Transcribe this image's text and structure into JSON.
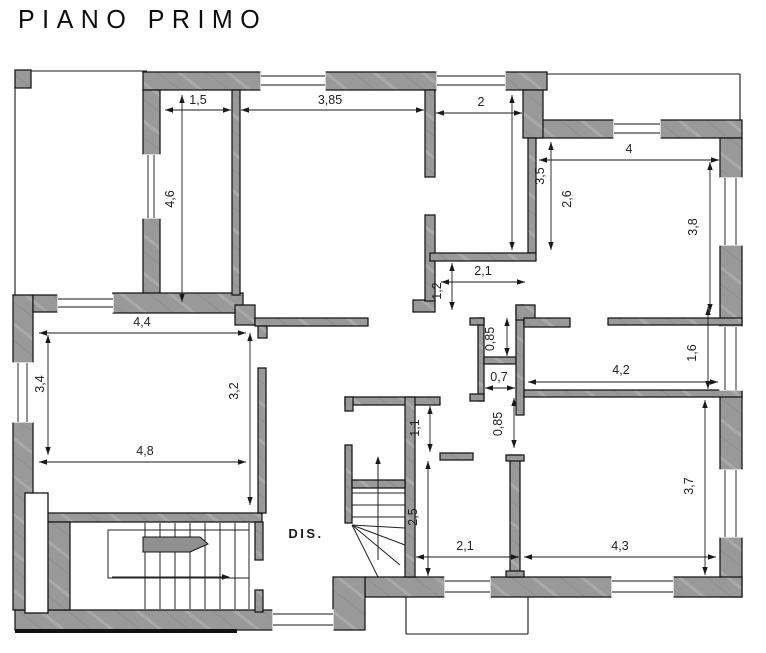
{
  "title": "PIANO PRIMO",
  "colors": {
    "wall_fill": "#999999",
    "wall_texture": "#adadad",
    "outline": "#141414",
    "dim_color": "#1a1a1a",
    "text_color": "#222222"
  },
  "room_labels": [
    {
      "t": "DIS.",
      "x": 306,
      "y": 538
    }
  ],
  "plan": {
    "walls": [
      [
        143,
        72,
        118,
        18
      ],
      [
        325,
        72,
        112,
        18
      ],
      [
        505,
        72,
        42,
        18
      ],
      [
        15,
        70,
        16,
        18
      ],
      [
        530,
        120,
        84,
        18
      ],
      [
        660,
        120,
        82,
        18
      ],
      [
        720,
        138,
        22,
        40
      ],
      [
        720,
        245,
        22,
        82
      ],
      [
        720,
        390,
        22,
        80
      ],
      [
        720,
        537,
        22,
        60
      ],
      [
        365,
        577,
        80,
        20
      ],
      [
        490,
        577,
        122,
        20
      ],
      [
        673,
        577,
        69,
        20
      ],
      [
        333,
        577,
        32,
        53
      ],
      [
        15,
        610,
        258,
        20
      ],
      [
        13,
        295,
        20,
        68
      ],
      [
        13,
        422,
        20,
        188
      ],
      [
        143,
        90,
        17,
        65
      ],
      [
        143,
        218,
        17,
        77
      ],
      [
        113,
        293,
        130,
        20
      ],
      [
        33,
        295,
        25,
        17
      ],
      [
        232,
        90,
        8,
        205
      ],
      [
        235,
        305,
        20,
        20
      ],
      [
        255,
        318,
        113,
        8
      ],
      [
        258,
        326,
        9,
        12
      ],
      [
        413,
        300,
        22,
        12
      ],
      [
        425,
        90,
        10,
        87
      ],
      [
        425,
        215,
        10,
        86
      ],
      [
        523,
        90,
        20,
        48
      ],
      [
        528,
        138,
        8,
        115
      ],
      [
        430,
        253,
        106,
        8
      ],
      [
        478,
        318,
        6,
        83
      ],
      [
        470,
        318,
        14,
        7
      ],
      [
        470,
        394,
        14,
        7
      ],
      [
        484,
        357,
        32,
        7
      ],
      [
        516,
        305,
        8,
        110
      ],
      [
        516,
        305,
        19,
        15
      ],
      [
        524,
        318,
        46,
        9
      ],
      [
        608,
        318,
        134,
        7
      ],
      [
        524,
        390,
        218,
        7
      ],
      [
        510,
        455,
        10,
        122
      ],
      [
        506,
        455,
        18,
        6
      ],
      [
        506,
        571,
        18,
        6
      ],
      [
        345,
        397,
        95,
        8
      ],
      [
        345,
        397,
        8,
        14
      ],
      [
        405,
        397,
        10,
        180
      ],
      [
        440,
        453,
        33,
        7
      ],
      [
        345,
        445,
        7,
        78
      ],
      [
        352,
        480,
        53,
        8
      ],
      [
        33,
        513,
        229,
        9
      ],
      [
        255,
        522,
        8,
        38
      ],
      [
        255,
        590,
        8,
        22
      ],
      [
        258,
        368,
        8,
        145
      ],
      [
        33,
        522,
        37,
        88
      ]
    ],
    "windows": [
      [
        261,
        72,
        64,
        18,
        "h"
      ],
      [
        437,
        72,
        68,
        18,
        "h"
      ],
      [
        614,
        120,
        46,
        18,
        "h"
      ],
      [
        720,
        178,
        22,
        67,
        "v"
      ],
      [
        720,
        327,
        22,
        63,
        "v"
      ],
      [
        720,
        470,
        22,
        67,
        "v"
      ],
      [
        13,
        363,
        20,
        59,
        "v"
      ],
      [
        143,
        155,
        17,
        63,
        "v"
      ],
      [
        445,
        577,
        45,
        20,
        "h"
      ],
      [
        612,
        577,
        61,
        20,
        "h"
      ],
      [
        273,
        610,
        60,
        20,
        "h"
      ],
      [
        58,
        295,
        55,
        17,
        "h"
      ]
    ],
    "shaft": {
      "x": 25,
      "y": 493,
      "w": 23,
      "h": 120
    },
    "thin_lines": [
      [
        15,
        71,
        147,
        71
      ],
      [
        15,
        71,
        15,
        295
      ],
      [
        547,
        74,
        740,
        74
      ],
      [
        740,
        74,
        740,
        120
      ],
      [
        406,
        597,
        406,
        634
      ],
      [
        406,
        634,
        528,
        634
      ],
      [
        528,
        597,
        528,
        634
      ]
    ],
    "black_strips": [
      [
        15,
        629,
        222,
        4
      ]
    ],
    "stairs_main": {
      "tread_x": [
        145,
        160,
        175,
        190,
        205,
        220,
        235,
        249
      ],
      "tread_y1": 523,
      "tread_y2": 609,
      "frame": [
        108,
        530,
        141,
        48
      ],
      "landing": "143,537 200,537 208,544 190,552 143,552",
      "arrow": [
        112,
        577,
        230,
        577
      ]
    },
    "stairs_small": {
      "treads": [
        [
          352,
          493,
          405,
          493
        ],
        [
          352,
          505,
          405,
          505
        ],
        [
          352,
          517,
          405,
          517
        ]
      ],
      "fan": [
        [
          352,
          525,
          405,
          528
        ],
        [
          352,
          525,
          405,
          545
        ],
        [
          352,
          525,
          400,
          565
        ],
        [
          352,
          525,
          378,
          577
        ]
      ],
      "arrow": [
        378,
        560,
        378,
        456
      ]
    },
    "dims_h": [
      {
        "t": "1,5",
        "x1": 165,
        "x2": 231,
        "y": 110,
        "lx": 198,
        "ly": 104
      },
      {
        "t": "3,85",
        "x1": 241,
        "x2": 424,
        "y": 110,
        "lx": 330,
        "ly": 104
      },
      {
        "t": "2",
        "x1": 436,
        "x2": 522,
        "y": 113,
        "lx": 481,
        "ly": 106
      },
      {
        "t": "4",
        "x1": 539,
        "x2": 719,
        "y": 160,
        "lx": 629,
        "ly": 153
      },
      {
        "t": "2,1",
        "x1": 441,
        "x2": 525,
        "y": 282,
        "lx": 483,
        "ly": 275
      },
      {
        "t": "4,4",
        "x1": 39,
        "x2": 246,
        "y": 333,
        "lx": 142,
        "ly": 326
      },
      {
        "t": "0,7",
        "x1": 485,
        "x2": 515,
        "y": 388,
        "lx": 499,
        "ly": 381
      },
      {
        "t": "4,2",
        "x1": 528,
        "x2": 718,
        "y": 382,
        "lx": 621,
        "ly": 374
      },
      {
        "t": "4,8",
        "x1": 39,
        "x2": 246,
        "y": 462,
        "lx": 145,
        "ly": 455
      },
      {
        "t": "2,1",
        "x1": 416,
        "x2": 519,
        "y": 557,
        "lx": 465,
        "ly": 550
      },
      {
        "t": "4,3",
        "x1": 524,
        "x2": 716,
        "y": 557,
        "lx": 620,
        "ly": 550
      }
    ],
    "dims_v": [
      {
        "t": "4,6",
        "x": 182,
        "y1": 95,
        "y2": 302,
        "lx": 174,
        "ly": 199
      },
      {
        "t": "3,5",
        "x": 512,
        "y1": 95,
        "y2": 250,
        "lx": 544,
        "ly": 176
      },
      {
        "t": "2,6",
        "x": 551,
        "y1": 142,
        "y2": 250,
        "lx": 571,
        "ly": 199
      },
      {
        "t": "3,8",
        "x": 710,
        "y1": 162,
        "y2": 312,
        "lx": 697,
        "ly": 227
      },
      {
        "t": "1,2",
        "x": 452,
        "y1": 263,
        "y2": 310,
        "lx": 441,
        "ly": 291
      },
      {
        "t": "0,85",
        "x": 507,
        "y1": 318,
        "y2": 356,
        "lx": 494,
        "ly": 339
      },
      {
        "t": "3,4",
        "x": 48,
        "y1": 335,
        "y2": 455,
        "lx": 44,
        "ly": 384
      },
      {
        "t": "3,2",
        "x": 250,
        "y1": 333,
        "y2": 505,
        "lx": 238,
        "ly": 391
      },
      {
        "t": "1,6",
        "x": 708,
        "y1": 307,
        "y2": 389,
        "lx": 696,
        "ly": 353
      },
      {
        "t": "0,85",
        "x": 514,
        "y1": 398,
        "y2": 448,
        "lx": 502,
        "ly": 424
      },
      {
        "t": "1,1",
        "x": 430,
        "y1": 406,
        "y2": 452,
        "lx": 419,
        "ly": 428
      },
      {
        "t": "2,5",
        "x": 428,
        "y1": 461,
        "y2": 576,
        "lx": 417,
        "ly": 517
      },
      {
        "t": "3,7",
        "x": 705,
        "y1": 400,
        "y2": 575,
        "lx": 693,
        "ly": 486
      }
    ]
  }
}
